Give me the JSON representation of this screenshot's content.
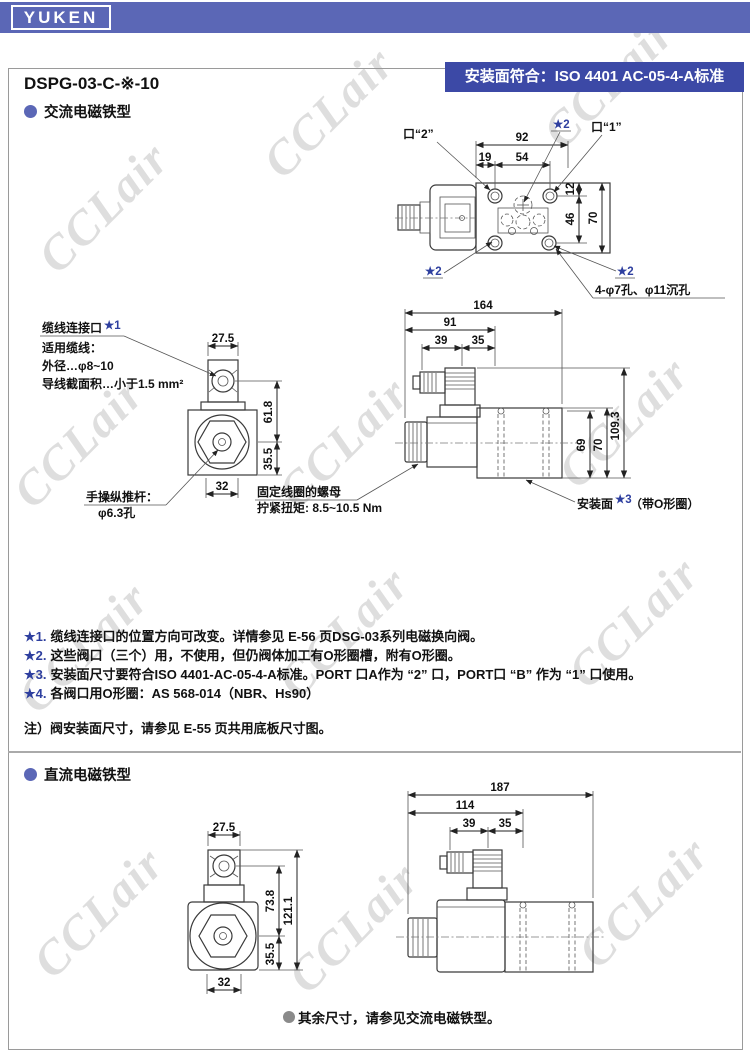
{
  "brand": "YUKEN",
  "header": {
    "model": "DSPG-03-C-※-10",
    "badge": "安装面符合：ISO 4401 AC-05-4-A标准"
  },
  "colors": {
    "brand_bar": "#5b67b6",
    "badge": "#3c49a6",
    "star_blue": "#2e3f9f",
    "watermark_gray": "#dedede"
  },
  "watermark": "CCLair",
  "sections": {
    "ac_title": "交流电磁铁型",
    "dc_title": "直流电磁铁型"
  },
  "top_view": {
    "port2": "口“2”",
    "port1": "口“1”",
    "star2": "★2",
    "dim_92": "92",
    "dim_19": "19",
    "dim_54": "54",
    "dim_12": "12",
    "dim_46": "46",
    "dim_70": "70",
    "holes_note": "4-φ7孔、φ11沉孔"
  },
  "ac_front": {
    "cable_title": "缆线连接口",
    "cable_star": "★1",
    "cable_line1": "适用缆线：",
    "cable_line2": "外径…φ8~10",
    "cable_line3": "导线截面积…小于1.5 mm²",
    "rod_line1": "手操纵推杆：",
    "rod_line2": "φ6.3孔",
    "dim_275": "27.5",
    "dim_618": "61.8",
    "dim_355": "35.5",
    "dim_32": "32"
  },
  "ac_side": {
    "dim_164": "164",
    "dim_91": "91",
    "dim_39": "39",
    "dim_35": "35",
    "dim_69": "69",
    "dim_70": "70",
    "dim_1093": "109.3",
    "nut_line1": "固定线圈的螺母",
    "nut_line2": "拧紧扭矩: 8.5~10.5 Nm",
    "mount_label": "安装面",
    "mount_star": "★3",
    "mount_suffix": "（带O形圈）"
  },
  "notes": [
    {
      "star": "★1.",
      "text": "缆线连接口的位置方向可改变。详情参见 E-56 页DSG-03系列电磁换向阀。"
    },
    {
      "star": "★2.",
      "text": "这些阀口（三个）用，不使用，但仍阀体加工有O形圈槽，附有O形圈。"
    },
    {
      "star": "★3.",
      "text": "安装面尺寸要符合ISO 4401-AC-05-4-A标准。PORT 口A作为 “2” 口，PORT口 “B” 作为 “1” 口使用。"
    },
    {
      "star": "★4.",
      "text": "各阀口用O形圈：AS 568-014（NBR、Hs90）"
    }
  ],
  "note_bottom": "注）阀安装面尺寸，请参见 E-55 页共用底板尺寸图。",
  "dc_front": {
    "dim_275": "27.5",
    "dim_738": "73.8",
    "dim_1211": "121.1",
    "dim_355": "35.5",
    "dim_32": "32"
  },
  "dc_side": {
    "dim_187": "187",
    "dim_114": "114",
    "dim_39": "39",
    "dim_35": "35"
  },
  "dc_footer": "其余尺寸，请参见交流电磁铁型。"
}
